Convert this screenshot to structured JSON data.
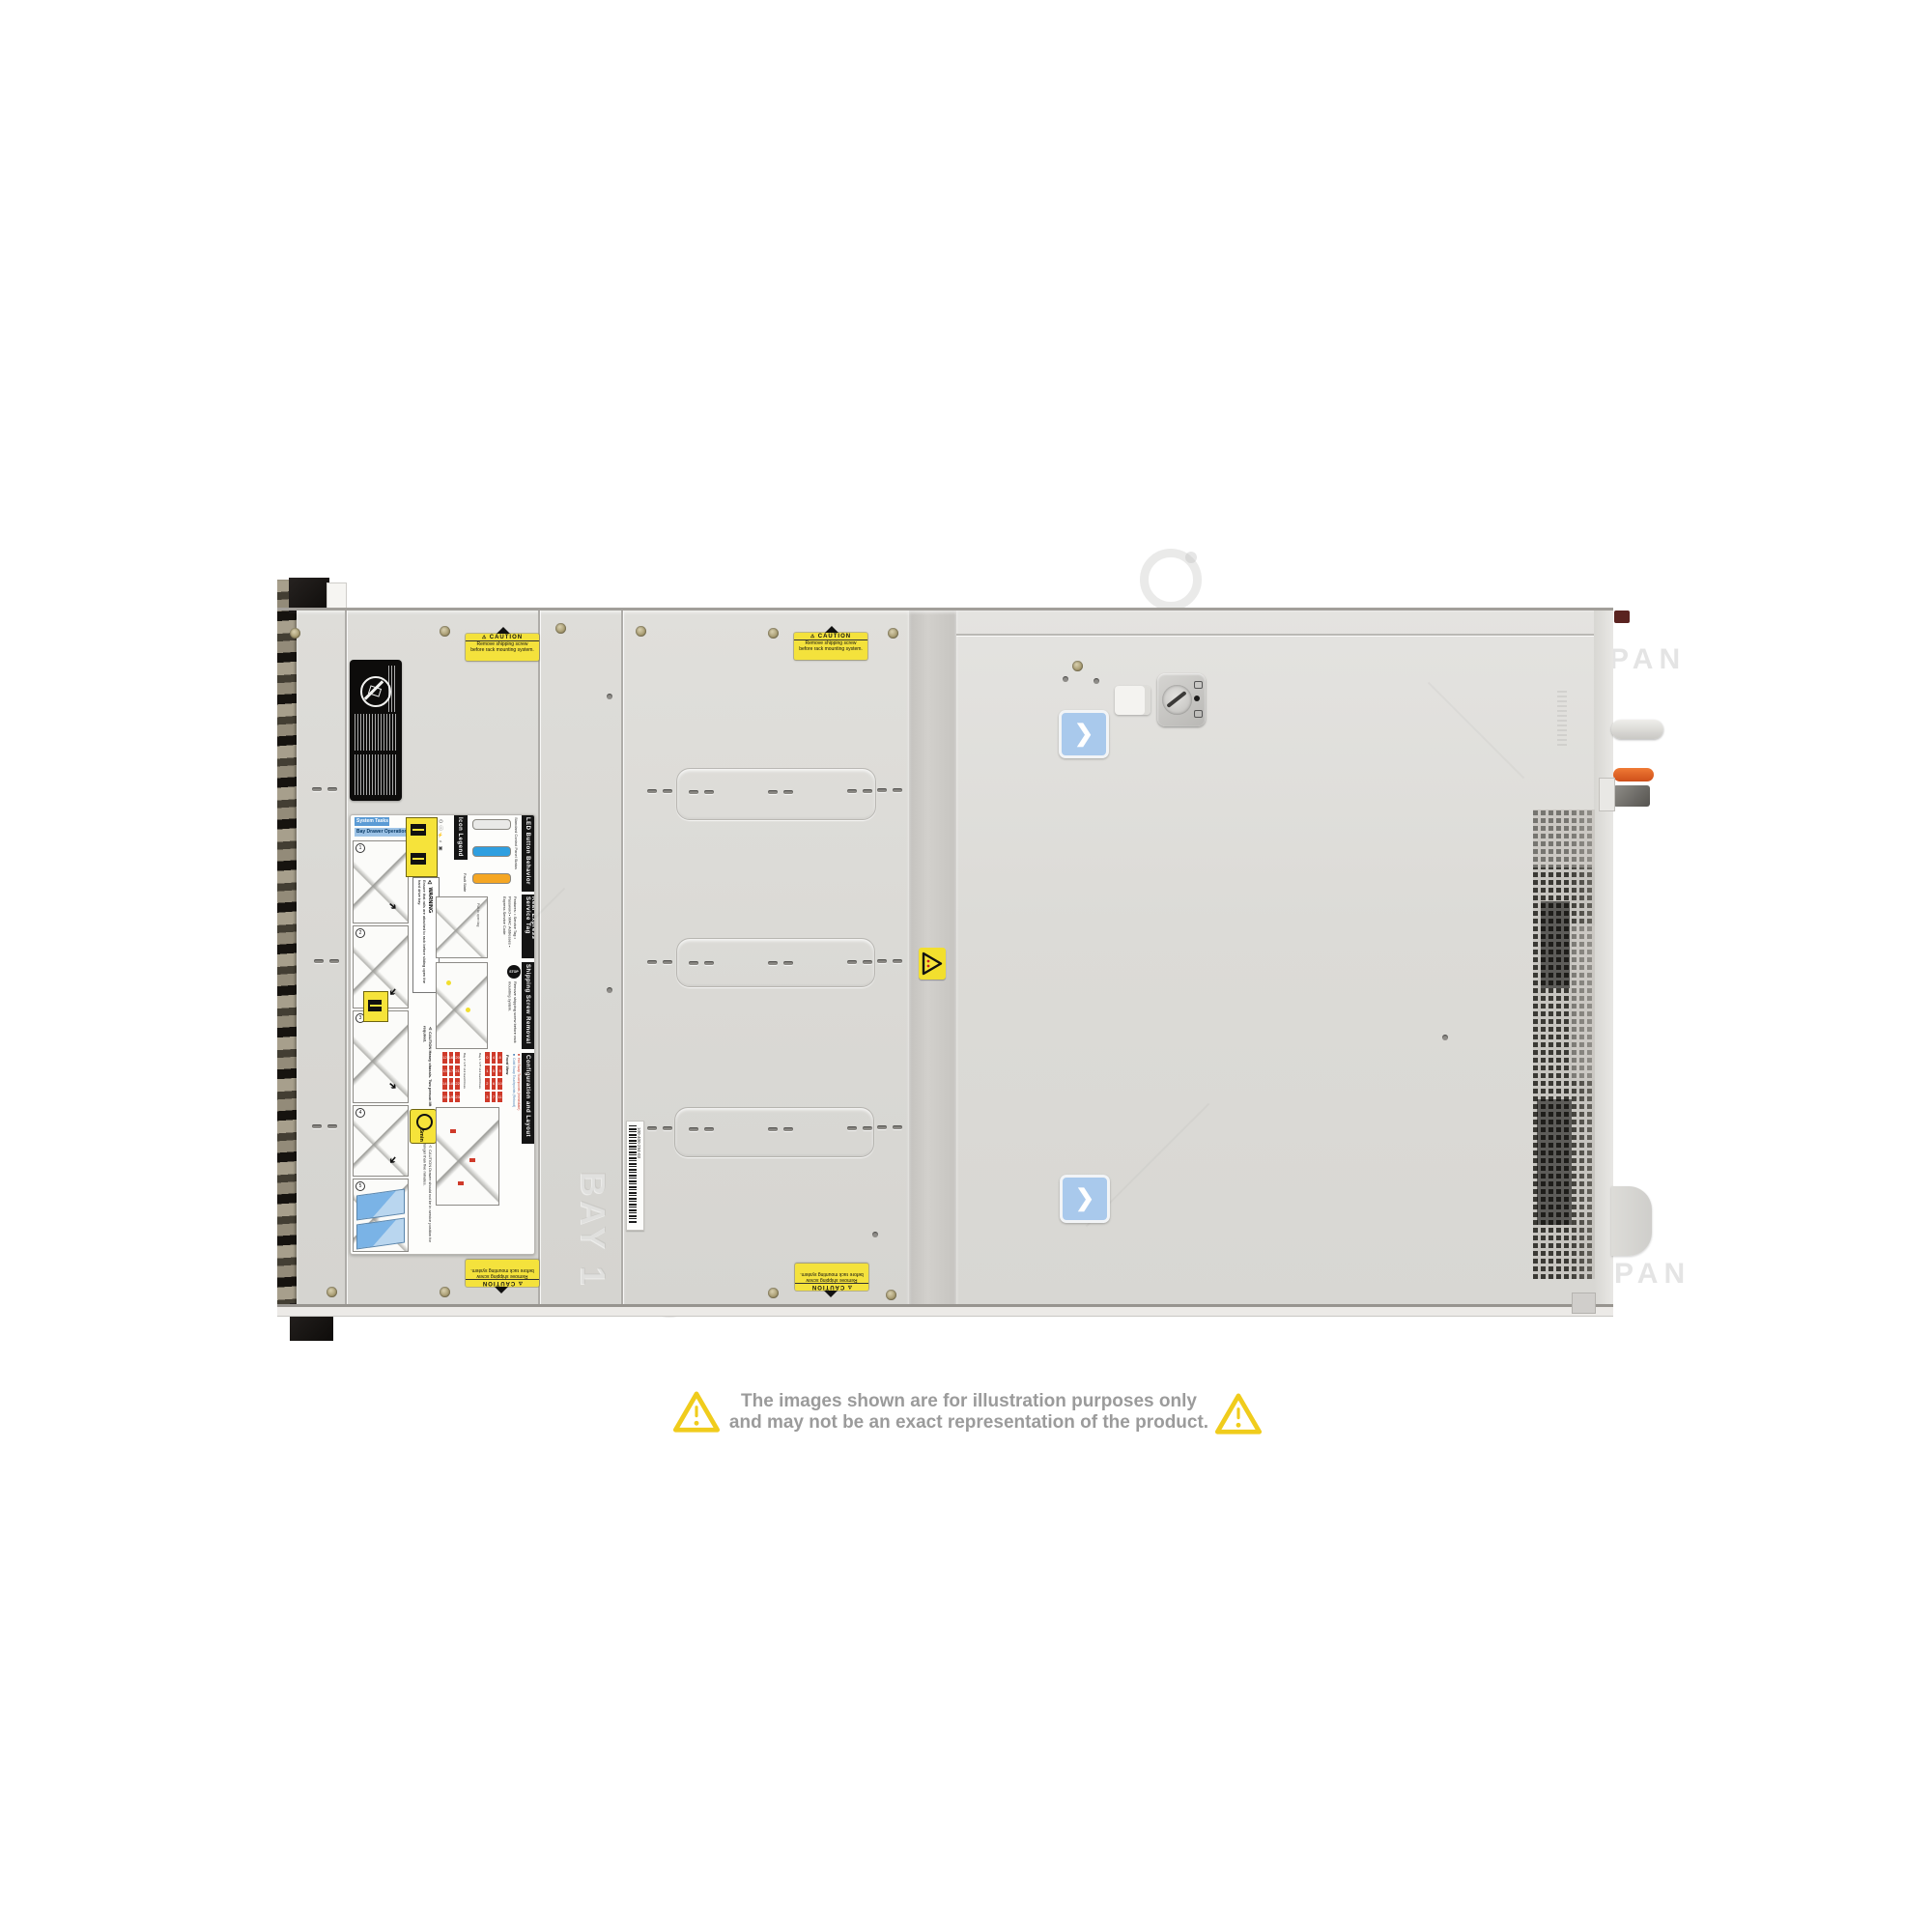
{
  "page": {
    "background": "#ffffff"
  },
  "watermark": {
    "text": "COMPAN",
    "text_positions": [
      [
        310,
        668
      ],
      [
        947,
        668
      ],
      [
        1578,
        666
      ],
      [
        785,
        827
      ],
      [
        620,
        986
      ],
      [
        1428,
        985
      ],
      [
        310,
        1302
      ],
      [
        947,
        1303
      ],
      [
        1583,
        1302
      ]
    ],
    "logo_positions": [
      [
        650,
        650,
        52
      ],
      [
        1295,
        658,
        48
      ],
      [
        975,
        972,
        62
      ],
      [
        660,
        1298,
        48
      ],
      [
        1180,
        568,
        46
      ]
    ]
  },
  "caution_sticker": {
    "title": "CAUTION",
    "line1": "Remove shipping screw",
    "line2": "before rack mounting system.",
    "bg_color": "#f4e23c",
    "placements": [
      [
        482,
        656,
        0
      ],
      [
        822,
        655,
        0
      ],
      [
        482,
        1304,
        1
      ],
      [
        823,
        1308,
        1
      ]
    ]
  },
  "blue_sticker": {
    "glyph": "❯",
    "positions": [
      [
        1096,
        735
      ],
      [
        1097,
        1216
      ]
    ]
  },
  "hazard_sticker": {
    "position": [
      951,
      981
    ]
  },
  "barcode_sticker": {
    "number": "100-400-294-03"
  },
  "embossed_text": "BAY 1",
  "regulatory_label": {
    "icon": "no-hammer-icon"
  },
  "service_label": {
    "title1": "System Tasks",
    "title2": "Bay Drawer Operation",
    "warning_title": "⚠ WARNING",
    "warning_text": "Ensure that rails are attached to rack before sliding open the hard drive bay.",
    "icon_legend": "Icon Legend",
    "icon_glyphs": "⏻  ⓘ  ⚡  ⌁  ▣",
    "led_header": "LED Button Behavior",
    "led_sub": "Standard Control Panel Status",
    "led_states": [
      {
        "label": "Normal State",
        "color": "#e9e9e7"
      },
      {
        "label": "",
        "color": "#2f9fe0"
      },
      {
        "label": "Fault State",
        "color": "#f5a623"
      }
    ],
    "service_tag_header": "Rear Express Service Tag",
    "service_tag_features": "Features:\n• Service Tag\n• Password\n• MAC Addresses\n• Express Service Code",
    "service_tag_hint": "Pull to open tag",
    "shipping_header": "Shipping Screw Removal",
    "shipping_stop": "STOP",
    "shipping_text": "Remove shipping screw before rack mounting system.",
    "config_header": "Configuration and Layout",
    "config_legend_hot": "■ Hot Swap Touchpoints (Immediate)",
    "config_legend_cold": "■ Cold Swap Touchpoints (Reboot)",
    "front_view": "Front View",
    "caution_heavy": "⚠ CAUTION\nHeavy chassis.\nTwo person lift required.",
    "five_min": "5min",
    "caution_drawer": "⚠ CAUTION\nDrawer should not be in service position for longer than five minutes.",
    "bays": [
      {
        "name": "Bay 1: 3.5\" x12 Hard Drives",
        "rows": [
          [
            0,
            4,
            8
          ],
          [
            1,
            5,
            9
          ],
          [
            2,
            6,
            10
          ],
          [
            3,
            7,
            11
          ]
        ]
      },
      {
        "name": "Bay 2: 3.5\" x12 Hard Drives",
        "rows": [
          [
            12,
            16,
            20
          ],
          [
            13,
            17,
            21
          ],
          [
            14,
            18,
            22
          ],
          [
            15,
            19,
            23
          ]
        ]
      }
    ],
    "steps": [
      "1",
      "2",
      "3",
      "4",
      "5"
    ]
  },
  "hardware": {
    "screws": [
      [
        305,
        655
      ],
      [
        460,
        653
      ],
      [
        580,
        650
      ],
      [
        663,
        653
      ],
      [
        800,
        655
      ],
      [
        924,
        655
      ],
      [
        343,
        1337
      ],
      [
        460,
        1337
      ],
      [
        800,
        1338
      ],
      [
        922,
        1340
      ]
    ],
    "rivets": [
      [
        628,
        718
      ],
      [
        628,
        1022
      ],
      [
        1493,
        1071
      ],
      [
        903,
        1275
      ]
    ],
    "slot_pairs": [
      [
        323,
        815
      ],
      [
        670,
        817
      ],
      [
        713,
        818
      ],
      [
        795,
        818
      ],
      [
        877,
        817
      ],
      [
        908,
        816
      ],
      [
        325,
        993
      ],
      [
        670,
        994
      ],
      [
        713,
        995
      ],
      [
        795,
        995
      ],
      [
        877,
        994
      ],
      [
        908,
        993
      ],
      [
        323,
        1164
      ],
      [
        670,
        1166
      ],
      [
        713,
        1167
      ],
      [
        795,
        1167
      ],
      [
        877,
        1166
      ],
      [
        908,
        1165
      ]
    ],
    "recessed_rects": [
      [
        700,
        795,
        205,
        52
      ],
      [
        700,
        971,
        204,
        49
      ],
      [
        698,
        1146,
        205,
        50
      ]
    ]
  },
  "disclaimer": {
    "line1": "The images shown are for illustration purposes only",
    "line2": "and may not be an exact representation of the product.",
    "text_color": "#9b9b9b",
    "triangle_color": "#f0cc1c"
  }
}
